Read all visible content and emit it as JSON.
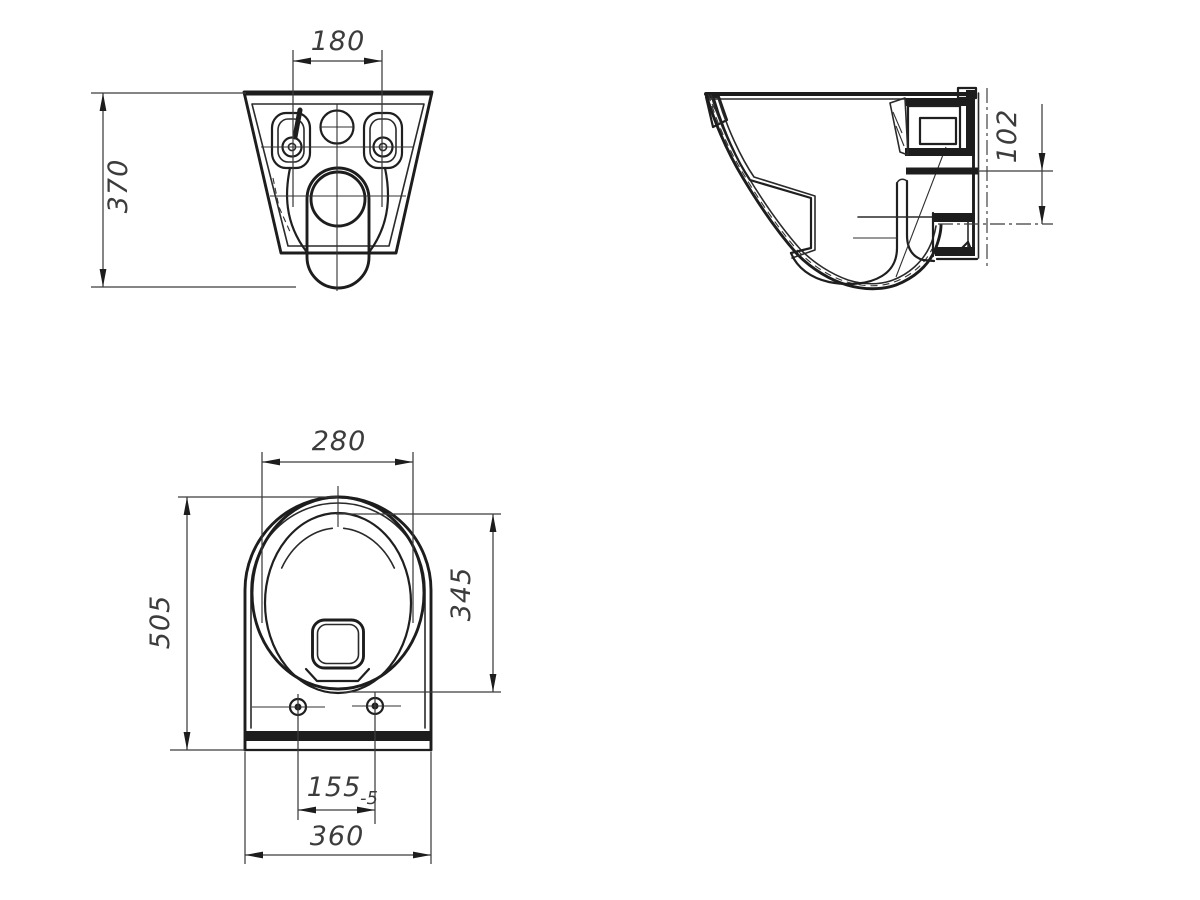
{
  "drawing": {
    "type": "technical-drawing",
    "subject": "Wall-hung toilet bowl - dimensional drawing, three orthographic views",
    "colors": {
      "line": "#1d1d1d",
      "thin_line": "#2e2e2e",
      "dim_text": "#3c3c3c",
      "background": "#ffffff"
    },
    "views": {
      "rear": {
        "label": "rear-view",
        "dims": {
          "mount_hole_spacing": "180",
          "overall_height": "370"
        }
      },
      "side": {
        "label": "side-view",
        "dims": {
          "inlet_to_outlet_offset": "102"
        }
      },
      "top": {
        "label": "top-view",
        "dims": {
          "bowl_inner_width": "280",
          "overall_depth": "505",
          "bowl_inner_length": "345",
          "fixing_hole_spacing": "155",
          "fixing_hole_tolerance": "-5",
          "body_width": "360"
        }
      }
    }
  }
}
